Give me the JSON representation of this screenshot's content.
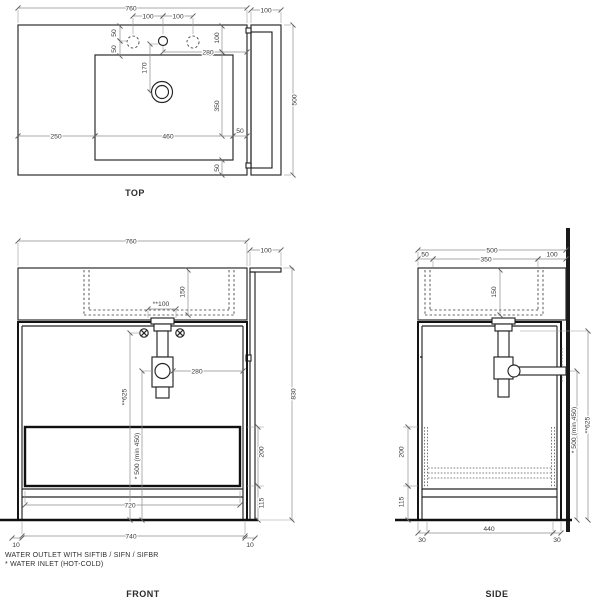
{
  "top_view": {
    "title": "TOP",
    "dims": {
      "overall_width": "760",
      "faucet_pitch_left": "100",
      "faucet_pitch_right": "100",
      "hole_offset_1": "50",
      "hole_offset_2": "50",
      "back_inset": "100",
      "faucet_to_edge": "280",
      "faucet_to_drain": "170",
      "drain_axis": "350",
      "left_margin": "250",
      "basin_width": "460",
      "right_margin": "50",
      "front_margin": "50",
      "side_panel_width": "100",
      "overall_depth": "500"
    }
  },
  "front_view": {
    "title": "FRONT",
    "dims": {
      "overall_width": "760",
      "side_panel_width": "100",
      "overall_height": "830",
      "basin_depth": "150",
      "outlet_pitch": "**100",
      "trap_to_side": "280",
      "outlet_height": "**625",
      "inlet_height": "* 500 (min 450)",
      "drawer_height": "200",
      "plinth_height": "115",
      "inner_width": "720",
      "base_width": "740",
      "leg_offset_left": "10",
      "leg_offset_right": "10"
    }
  },
  "side_view": {
    "title": "SIDE",
    "dims": {
      "overall_depth": "500",
      "front_offset": "50",
      "drain_offset": "350",
      "back_offset": "100",
      "basin_depth": "150",
      "drawer_height": "200",
      "plinth_height": "115",
      "base_depth": "440",
      "leg_offset_front": "30",
      "leg_offset_back": "30",
      "inlet_height": "* 500 (min 450)",
      "outlet_height": "**625"
    }
  },
  "notes": {
    "outlet": "WATER OUTLET WITH SIFTIB / SIFN / SIFBR",
    "inlet": "* WATER INLET (HOT-COLD)"
  }
}
